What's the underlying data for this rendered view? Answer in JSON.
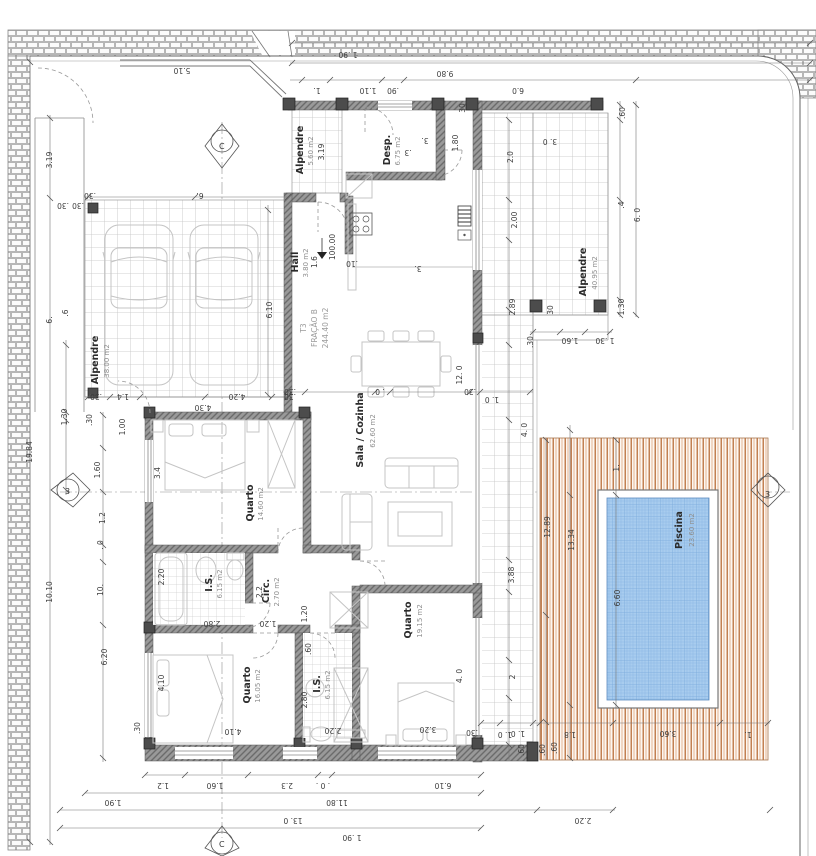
{
  "plan": {
    "fraction": {
      "t3": "T3",
      "name": "FRAÇÃO B",
      "area": "244.40 m2"
    },
    "level": "100.00",
    "markers": {
      "v": "C",
      "h": "3"
    },
    "colors": {
      "wall": "#969696",
      "deck_wood": "#b4622a",
      "pool_water": "#a8ccee",
      "tile_line": "#c2c2c2"
    },
    "rooms": [
      {
        "name": "Alpendre",
        "area": "5.60 m2"
      },
      {
        "name": "Desp.",
        "area": "6.75 m2"
      },
      {
        "name": "Hall",
        "area": "3.80 m2"
      },
      {
        "name": "Alpendre",
        "area": "40.95 m2"
      },
      {
        "name": "Alpendre",
        "area": "38.00 m2"
      },
      {
        "name": "Sala / Cozinha",
        "area": "62.60 m2"
      },
      {
        "name": "Quarto",
        "area": "14.60 m2"
      },
      {
        "name": "I.S.",
        "area": "6.15 m2"
      },
      {
        "name": "Circ.",
        "area": "2.70 m2"
      },
      {
        "name": "Quarto",
        "area": "16.05 m2"
      },
      {
        "name": "I.S.",
        "area": "6.15 m2"
      },
      {
        "name": "Quarto",
        "area": "19.15 m2"
      },
      {
        "name": "Piscina",
        "area": "23.60 m2"
      }
    ],
    "dims": {
      "t0": "1 .90",
      "t1": "9.80",
      "t2": "1.",
      "t3": "1.10",
      "t4": ".90",
      "t5": "6.0",
      "t6": "5.10",
      "b0": "1.2",
      "b1": "1.60",
      "b2": "2.3",
      "b3": ". 0 .",
      "b4": "6.10",
      "b5": "1.90",
      "b6": "11.80",
      "b7": "13. 0",
      "b8": "1 .90",
      "b9": "2.20",
      "l0": "19.84",
      "l1": "3.19",
      "l2": ".30",
      "l3": ".30",
      "l4": "10.10",
      "l5": "10.",
      "l6": "6.20",
      "l7": "1.30",
      "l8": ".30",
      "l9": "1.60",
      "l10": "1.2",
      "l11": ". 0",
      "l12": "6.",
      "l13": ".6",
      "c0": ".30",
      "c1": "6.",
      "c2": "1.4",
      "c3": ".30",
      "c4": "4.20",
      "c5": ".30",
      "c6": "6.10",
      "c7": "1.00",
      "c8": "4.30",
      "r0": ".60",
      "r1": "3. 0",
      "r2": "2.0",
      "r3": "6. 0",
      "r4": ".4",
      "r5": "2.00",
      "r6": "2.89",
      "r7": "1.30",
      "r8": ".30",
      "r9": "30",
      "r10": "1.60",
      "r11": "1 .30",
      "e0": "4. 0",
      "e1": "3.88",
      "e2": "2",
      "e3": "1. 0",
      "e4": ".60",
      "e5": "12. 0",
      "e6": "1. 0",
      "p0": "1.",
      "p1": "12.89",
      "p2": "13.34",
      "p3": "6.60",
      "p4": "3.60",
      "p5": "1.8",
      "p6": "1. 0",
      "p7": "1.",
      "p8": ".60",
      "p9": ".60",
      "p10": ".30",
      "i0": ".30",
      "i1": ". 0",
      "i2": ".30",
      "i3": "3.4",
      "i4": "2.20",
      "i5": "2.2",
      "i6": "1.20",
      "i7": "2.80",
      "i8": "1.20",
      "i9": ".60",
      "i10": "4.10",
      "i11": "4.10",
      "i12": ".30",
      "i13": "2.80",
      "i14": "2.20",
      "i15": "3.20",
      "i16": "4. 0",
      "i17": "1.6",
      "i18": "1.80",
      "i19": "3.",
      "i20": "30",
      "i21": ".3",
      "i22": ".10",
      "i23": "3.",
      "i24": "3.19"
    }
  }
}
